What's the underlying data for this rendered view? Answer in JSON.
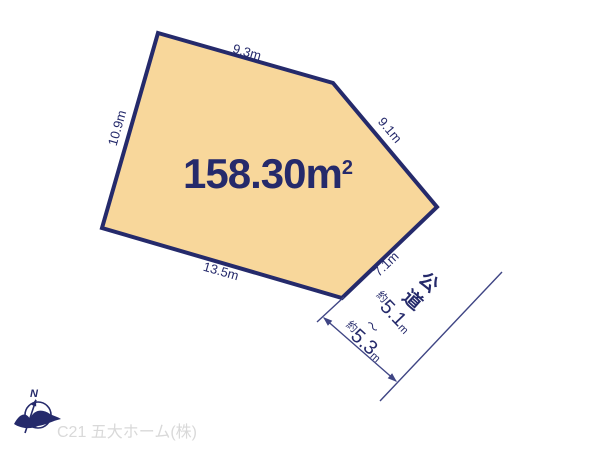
{
  "colors": {
    "plot_fill": "#f8d79b",
    "navy": "#252a6b",
    "thin_line": "#3f4584",
    "footer_gray": "#d9d9d9"
  },
  "plot": {
    "area_value": "158.30m",
    "area_sup": "2",
    "edges": [
      "9.3m",
      "10.9m",
      "9.1m",
      "7.1m",
      "13.5m"
    ]
  },
  "road": {
    "name": "公道",
    "width_min_prefix": "約",
    "width_min_value": "5.1",
    "width_min_unit": "m",
    "range_separator": "～",
    "width_max_prefix": "約",
    "width_max_value": "5.3",
    "width_max_unit": "m"
  },
  "compass": {
    "north_label": "N"
  },
  "footer": {
    "company_label": "C21 五大ホーム(株)"
  }
}
